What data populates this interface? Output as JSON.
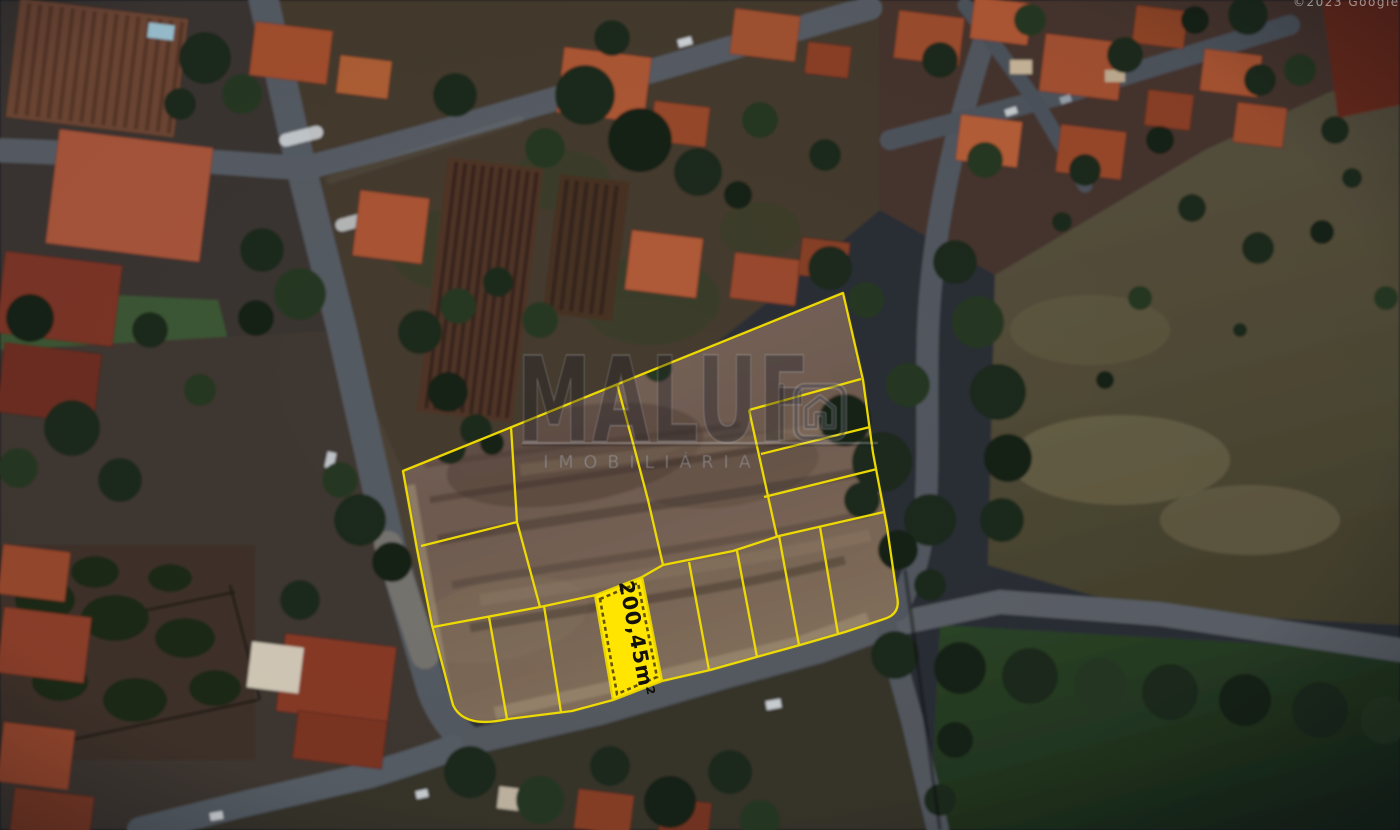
{
  "map_overlay": {
    "highlighted_lot": {
      "area_label": "200,45m²"
    },
    "line_color": "#F2DE00",
    "highlight_fill": "#FFE500",
    "label_color": "#13110A"
  },
  "watermark": {
    "brand": "MALUF",
    "subtitle": "IMOBILIÁRIA",
    "icon": "house-icon"
  },
  "attribution": "©2023 Google"
}
